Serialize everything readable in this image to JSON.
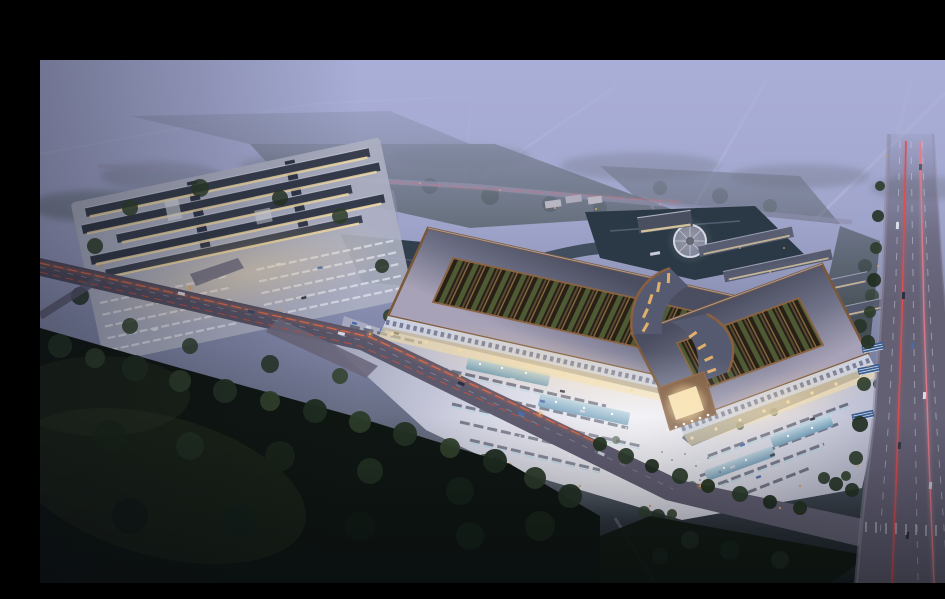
{
  "meta": {
    "type": "architectural-aerial-rendering",
    "description": "Dusk aerial rendering of a large market / exhibition complex: two bronze-trimmed halls with planted open courtyards joined by a central gate, a brightly lit forecourt plaza with parking rows and reflecting pools, a secondary retail cluster to the west, a pond with a circular island plaza, row buildings to the northeast, dark tree belts in the foreground and arterial roads with red car-light trails fading into violet haze.",
    "time_of_day": "dusk",
    "letterbox_top_height_px": 44
  },
  "palette": {
    "letterbox": "#000000",
    "sky_top": "#a6abd4",
    "sky_mid": "#8e94b8",
    "haze": "#a9aed7",
    "forest_dark": "#0f1612",
    "tree_green": "#2c3c2a",
    "field_green": "#2d3a2e",
    "road_asphalt": "#615e72",
    "road_light": "#8e8aa0",
    "plaza_light": "#d6d7e4",
    "plaza_bright": "#f0f0f6",
    "roof_slate": "#4e5164",
    "roof_lavender": "#a8a2b8",
    "bronze": "#7c583a",
    "bronze_bright": "#a87c4f",
    "courtyard_dark": "#281f16",
    "planting_green": "#4d5a33",
    "window_warm": "#f2dca8",
    "lamp_amber": "#e0a35c",
    "trail_red": "#d8554e",
    "trail_orange": "#e8734f",
    "pool_blue": "#7fa8c4",
    "stall_teal": "#7fd8e8",
    "water_dark": "#2b3946",
    "car_blue": "#4a6aa8"
  },
  "scene": {
    "regions": [
      {
        "name": "letterbox-top",
        "description": "black letterbox bar across the top of the frame"
      },
      {
        "name": "twilight-sky-haze",
        "description": "violet dusk haze over distant fields and tree lines"
      },
      {
        "name": "distant-roads",
        "description": "faint empty roads receding into the fog toward the horizon"
      },
      {
        "name": "perimeter-greenery",
        "description": "green buffer fields and tree belts around the site"
      },
      {
        "name": "west-retail-complex",
        "description": "cluster of long retail buildings with lit facades and a striped parking court"
      },
      {
        "name": "market-hall-west",
        "description": "west market hall: bronze-edged roof frame around a planted courtyard, lit colonnade"
      },
      {
        "name": "market-hall-east",
        "description": "east market hall: bronze-edged roof frame around a planted courtyard, lit colonnade"
      },
      {
        "name": "central-gate",
        "description": "central bronze gate pavilion with glowing portal and curved swooping roofs"
      },
      {
        "name": "forecourt-plaza",
        "description": "bright paved forecourt with parking rows, reflecting pools, fountains and visitors"
      },
      {
        "name": "pond-island-plaza",
        "description": "landscape pond with a circular island plaza behind the halls"
      },
      {
        "name": "northeast-row-buildings",
        "description": "rows of slate-roofed outbuildings northeast of the halls"
      },
      {
        "name": "arterial-road",
        "description": "wide arterial road on the right with lane markings and red light trails"
      },
      {
        "name": "approach-road",
        "description": "diagonal approach road with orange light trails, lamps and traffic"
      },
      {
        "name": "foreground-forest",
        "description": "dark forest and meadow in the lower-left foreground"
      }
    ]
  }
}
